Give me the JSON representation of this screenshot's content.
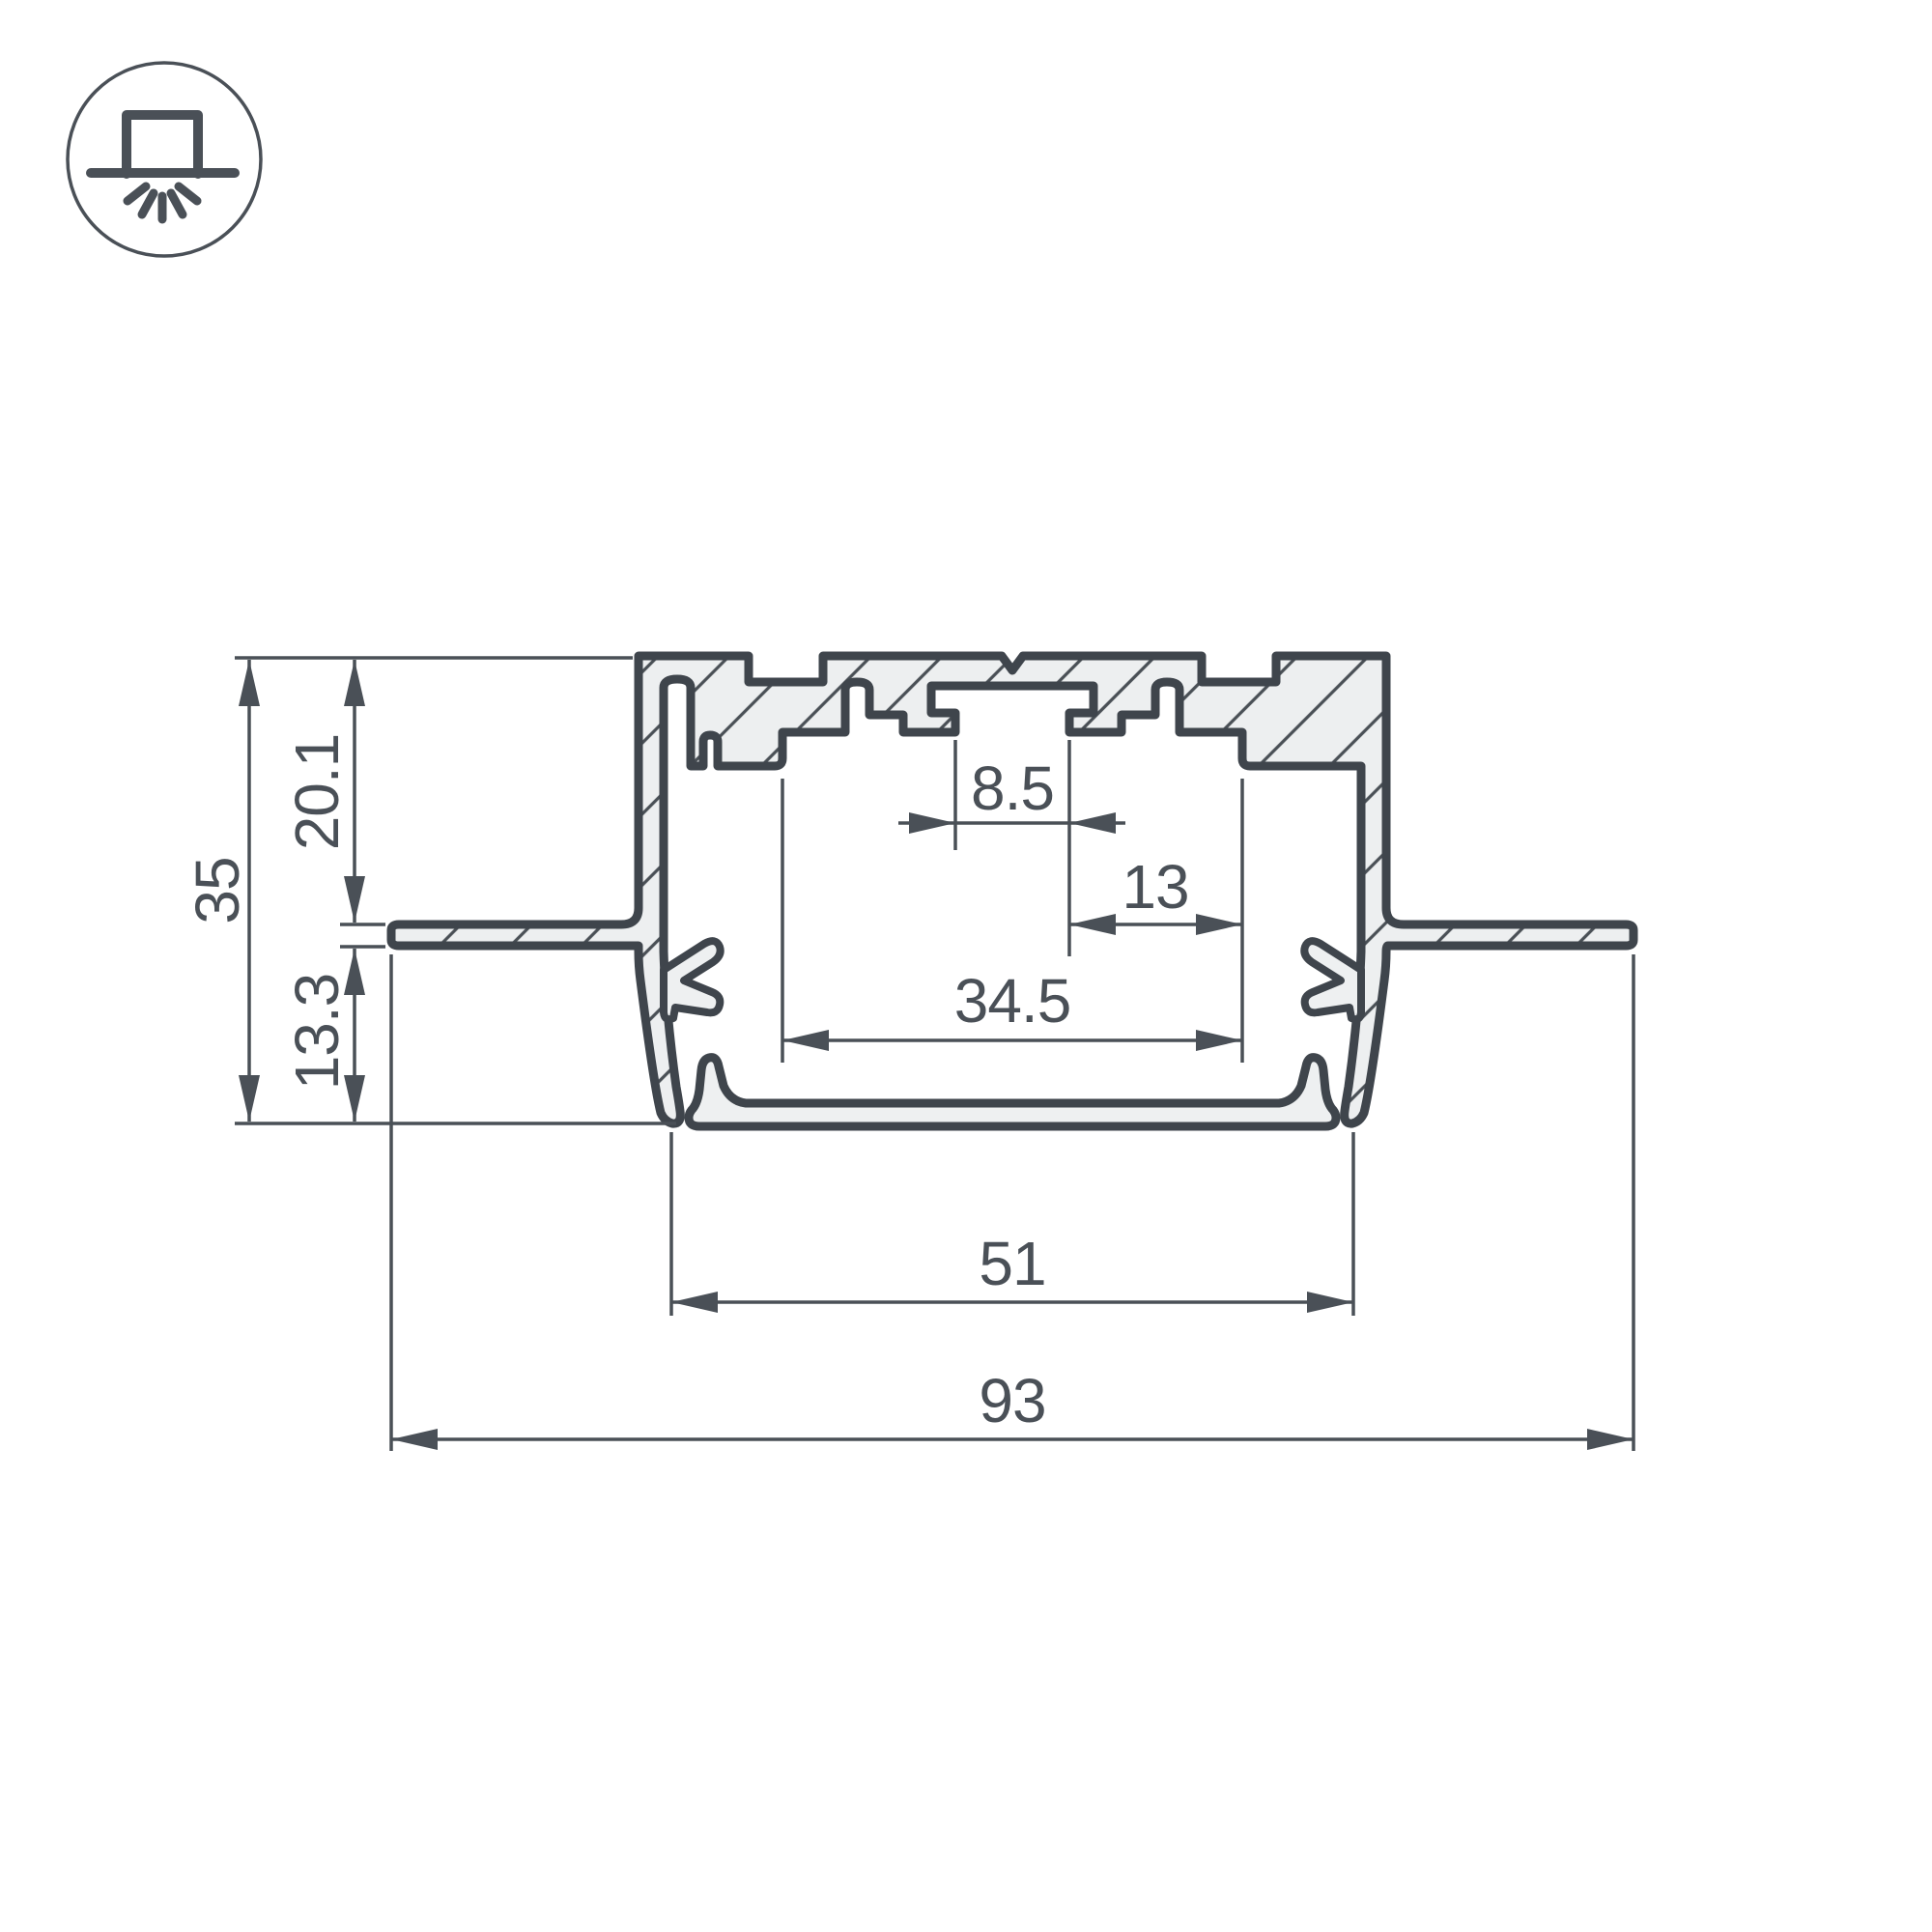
{
  "drawing": {
    "kind": "profile-cross-section-dimension-drawing",
    "icon": {
      "name": "recessed-mount-light-icon"
    },
    "colors": {
      "outline": "#3f454c",
      "dimension": "#4a5057",
      "metal_fill": "#edeff0",
      "background": "#ffffff"
    },
    "dimensions": {
      "total_height": {
        "value": "35"
      },
      "upper_height": {
        "value": "20.1"
      },
      "lower_height": {
        "value": "13.3"
      },
      "slot_width": {
        "value": "8.5"
      },
      "slot_offset": {
        "value": "13"
      },
      "inner_width": {
        "value": "34.5"
      },
      "body_width": {
        "value": "51"
      },
      "overall_width": {
        "value": "93"
      }
    }
  }
}
